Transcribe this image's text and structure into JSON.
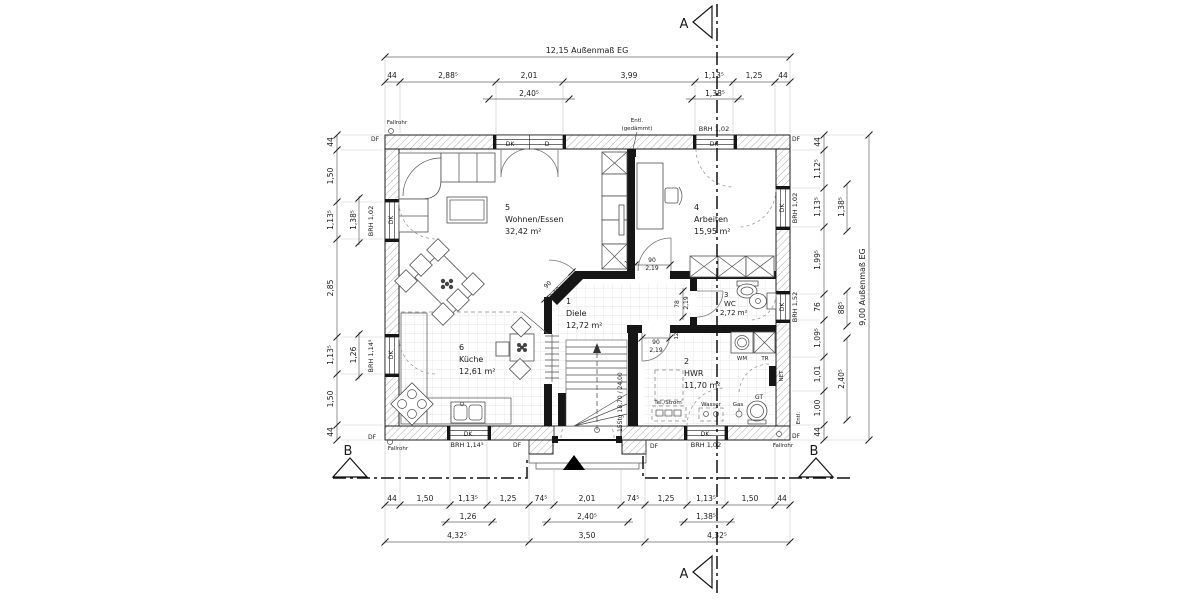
{
  "sections": {
    "a": "A",
    "b": "B"
  },
  "dims": {
    "top_overall": "12,15 Außenmaß EG",
    "right_overall": "9,00 Außenmaß EG",
    "top": [
      "44",
      "2,88⁵",
      "2,01",
      "3,99",
      "1,13⁵",
      "1,25",
      "44"
    ],
    "top_sub": [
      "2,40⁵",
      "1,38⁵"
    ],
    "left": [
      "44",
      "1,50",
      "1,13⁵",
      "2,85",
      "1,13⁵",
      "1,50",
      "44"
    ],
    "left_sub": [
      "1,38⁵",
      "1,26"
    ],
    "right": [
      "44",
      "1,12⁵",
      "1,13⁵",
      "1,99⁵",
      "76",
      "1,09⁵",
      "1,01",
      "1,00",
      "44"
    ],
    "right_sub": [
      "1,38⁵",
      "88⁵",
      "2,40⁵"
    ],
    "bottom": [
      "44",
      "1,50",
      "1,13⁵",
      "1,25",
      "74⁵",
      "2,01",
      "74⁵",
      "1,25",
      "1,13⁵",
      "1,50",
      "44"
    ],
    "bottom_sub": [
      "1,26",
      "2,40⁵",
      "1,38⁵"
    ],
    "bottom_totals": [
      "4,32⁵",
      "3,50",
      "4,32⁵"
    ]
  },
  "rooms": [
    {
      "num": "1",
      "name": "Diele",
      "area": "12,72 m²"
    },
    {
      "num": "2",
      "name": "HWR",
      "area": "11,70 m²"
    },
    {
      "num": "3",
      "name": "WC",
      "area": "2,72 m²"
    },
    {
      "num": "4",
      "name": "Arbeiten",
      "area": "15,95 m²"
    },
    {
      "num": "5",
      "name": "Wohnen/Essen",
      "area": "32,42 m²"
    },
    {
      "num": "6",
      "name": "Küche",
      "area": "12,61 m²"
    }
  ],
  "windows": {
    "left_top": "BRH 1,02",
    "left_bottom": "BRH 1,14⁵",
    "top": "BRH 1,02",
    "right_top": "BRH 1,02",
    "right_wc": "BRH 1,52",
    "bottom_kitchen": "BRH 1,14⁵",
    "bottom_hwr": "BRH 1,02"
  },
  "doors": {
    "w90": "90",
    "h219": "2,19",
    "w78": "78",
    "t125": "12⁵"
  },
  "stairs_label": "15Stg 18,70 / 24,00",
  "labels": {
    "dk": "DK",
    "d": "D",
    "df": "DF",
    "fallrohr": "Fallrohr",
    "entl": "Entl.",
    "gedaemmt": "(gedämmt)",
    "wm": "WM",
    "tr": "TR",
    "gt": "GT",
    "gas": "Gas",
    "wasser": "Wasser",
    "net": "NET",
    "tel_strom": "Tel./Strom"
  }
}
